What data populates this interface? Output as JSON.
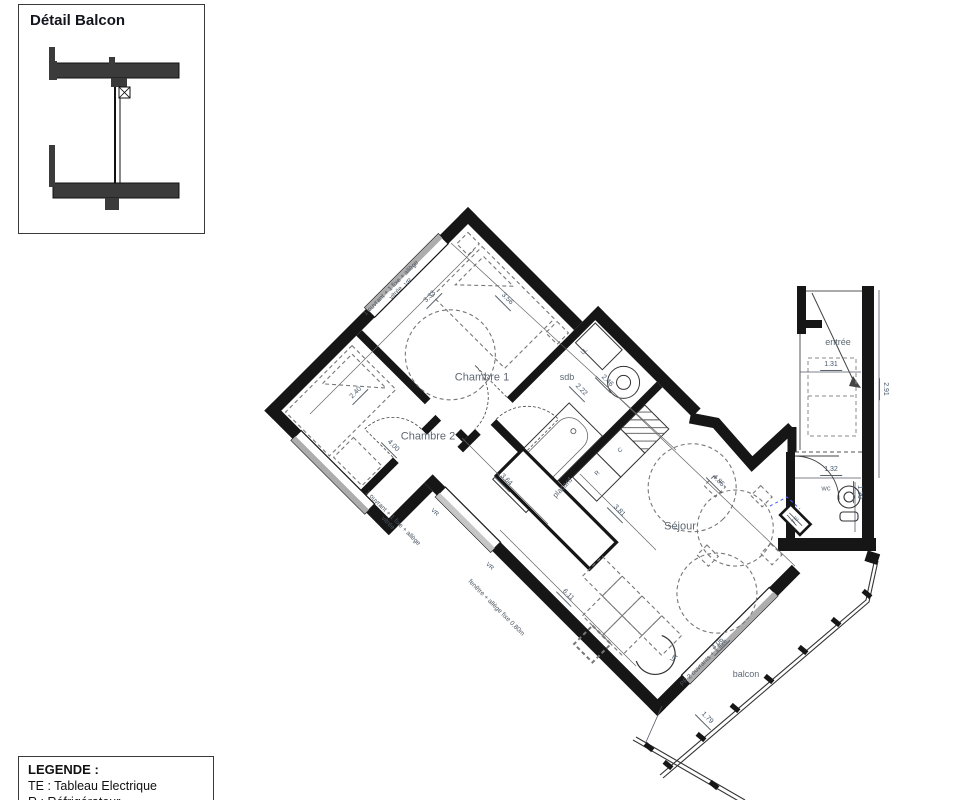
{
  "detail_box": {
    "title": "Détail Balcon"
  },
  "legend": {
    "title": "LEGENDE :",
    "items": [
      "TE : Tableau Electrique",
      "R : Réfrigérateur"
    ]
  },
  "colors": {
    "wall": "#161616",
    "window_gray": "#adadad",
    "dim_text": "#44556a",
    "room_text": "#5d6873",
    "accent_blue": "#4a5cff"
  },
  "plan": {
    "rooms": [
      "Chambre 1",
      "Chambre 2",
      "Séjour",
      "sdb",
      "entrée",
      "wc",
      "balcon",
      "placard"
    ],
    "labels": [
      {
        "text": "Chambre 1",
        "x": 482,
        "y": 378,
        "rot": 0,
        "kind": "room",
        "name": "room-label-chambre1"
      },
      {
        "text": "Chambre 2",
        "x": 428,
        "y": 437,
        "rot": 0,
        "kind": "room",
        "name": "room-label-chambre2"
      },
      {
        "text": "Séjour",
        "x": 680,
        "y": 527,
        "rot": 0,
        "kind": "room",
        "name": "room-label-sejour"
      },
      {
        "text": "sdb",
        "x": 567,
        "y": 377,
        "rot": 0,
        "kind": "room-sm",
        "name": "room-label-sdb"
      },
      {
        "text": "entrée",
        "x": 838,
        "y": 342,
        "rot": 0,
        "kind": "room-sm",
        "name": "room-label-entree"
      },
      {
        "text": "balcon",
        "x": 746,
        "y": 674,
        "rot": 0,
        "kind": "room-sm",
        "name": "room-label-balcon"
      },
      {
        "text": "wc",
        "x": 826,
        "y": 489,
        "rot": 0,
        "kind": "room-xs",
        "name": "room-label-wc"
      },
      {
        "text": "placard",
        "x": 563,
        "y": 488,
        "rot": -47,
        "kind": "room-xs",
        "name": "room-label-placard"
      },
      {
        "text": "3.33",
        "x": 431,
        "y": 298,
        "rot": -45,
        "kind": "dim",
        "name": "dim-3-33"
      },
      {
        "text": "3.56",
        "x": 506,
        "y": 300,
        "rot": 45,
        "kind": "dim",
        "name": "dim-3-56"
      },
      {
        "text": "2.40",
        "x": 357,
        "y": 394,
        "rot": -45,
        "kind": "dim",
        "name": "dim-2-40"
      },
      {
        "text": "4.00",
        "x": 392,
        "y": 447,
        "rot": 45,
        "kind": "dim",
        "name": "dim-4-00"
      },
      {
        "text": "2.22",
        "x": 580,
        "y": 391,
        "rot": 45,
        "kind": "dim",
        "name": "dim-2-22"
      },
      {
        "text": "2.46",
        "x": 606,
        "y": 382,
        "rot": 45,
        "kind": "dim",
        "name": "dim-2-46"
      },
      {
        "text": "3.64",
        "x": 505,
        "y": 481,
        "rot": 45,
        "kind": "dim",
        "name": "dim-3-64"
      },
      {
        "text": "3.81",
        "x": 618,
        "y": 512,
        "rot": 45,
        "kind": "dim",
        "name": "dim-3-81"
      },
      {
        "text": "6.11",
        "x": 567,
        "y": 596,
        "rot": 45,
        "kind": "dim",
        "name": "dim-6-11"
      },
      {
        "text": "4.85",
        "x": 717,
        "y": 482,
        "rot": 45,
        "kind": "dim",
        "name": "dim-4-85"
      },
      {
        "text": "4.06",
        "x": 719,
        "y": 645,
        "rot": -45,
        "kind": "dim",
        "name": "dim-4-06"
      },
      {
        "text": "1.79",
        "x": 706,
        "y": 719,
        "rot": 45,
        "kind": "dim",
        "name": "dim-1-79"
      },
      {
        "text": "1.31",
        "x": 831,
        "y": 366,
        "rot": 0,
        "kind": "dim",
        "name": "dim-1-31"
      },
      {
        "text": "2.91",
        "x": 884,
        "y": 389,
        "rot": 90,
        "kind": "dim",
        "name": "dim-2-91"
      },
      {
        "text": "1.32",
        "x": 831,
        "y": 471,
        "rot": 0,
        "kind": "dim",
        "name": "dim-1-32"
      },
      {
        "text": "1.30",
        "x": 858,
        "y": 492,
        "rot": 90,
        "kind": "dim",
        "name": "dim-1-30"
      },
      {
        "text": "1 ouvrant + 1 fixe + allège\nvitrée",
        "x": 394,
        "y": 291,
        "rot": -45,
        "kind": "annot",
        "name": "window-annotation-chambre1"
      },
      {
        "text": "1 ouvrant + 1 fixe + allège\nvitrée",
        "x": 390,
        "y": 521,
        "rot": 45,
        "kind": "annot",
        "name": "window-annotation-chambre2"
      },
      {
        "text": "fenêtre + allège fixe 0.80m",
        "x": 496,
        "y": 608,
        "rot": 45,
        "kind": "annot",
        "name": "window-annotation-sejour"
      },
      {
        "text": "PF 2 ouvrants + 1 fixe",
        "x": 704,
        "y": 663,
        "rot": -45,
        "kind": "annot",
        "name": "window-annotation-balcon"
      },
      {
        "text": "VR",
        "x": 409,
        "y": 283,
        "rot": -45,
        "kind": "tiny",
        "name": "vr-label"
      },
      {
        "text": "VR",
        "x": 434,
        "y": 513,
        "rot": 45,
        "kind": "tiny",
        "name": "vr-label"
      },
      {
        "text": "VR",
        "x": 489,
        "y": 567,
        "rot": 45,
        "kind": "tiny",
        "name": "vr-label"
      },
      {
        "text": "VR",
        "x": 675,
        "y": 659,
        "rot": -45,
        "kind": "tiny",
        "name": "vr-label"
      },
      {
        "text": "LL",
        "x": 585,
        "y": 352,
        "rot": -45,
        "kind": "tiny",
        "name": "washing-machine-label"
      },
      {
        "text": "C",
        "x": 621,
        "y": 451,
        "rot": -45,
        "kind": "tiny",
        "name": "cooker-label"
      },
      {
        "text": "R",
        "x": 598,
        "y": 474,
        "rot": -45,
        "kind": "tiny",
        "name": "fridge-label"
      },
      {
        "text": "TE",
        "x": 796,
        "y": 521,
        "rot": -45,
        "kind": "tiny",
        "name": "electrical-panel-label"
      }
    ]
  }
}
